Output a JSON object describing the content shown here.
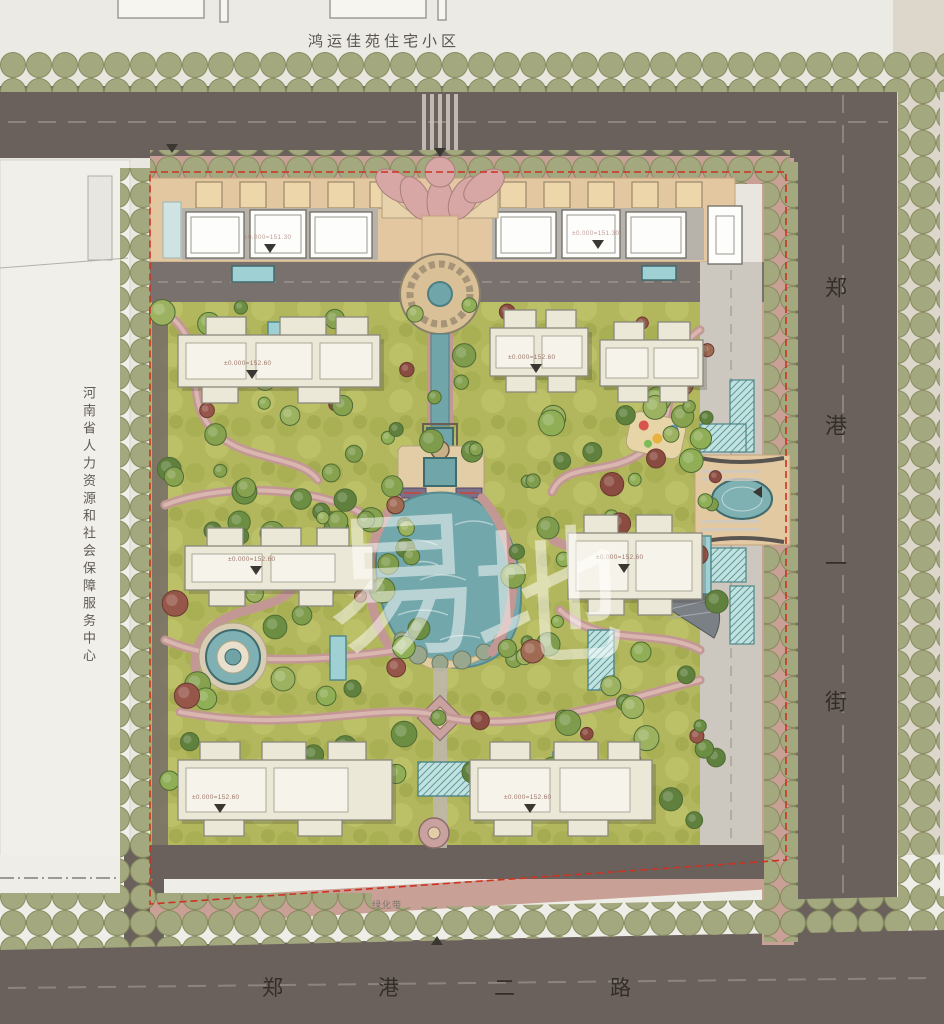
{
  "site": {
    "north_neighbor": "鸿运佳苑住宅小区",
    "west_neighbor": "河南省人力资源和社会保障服务中心",
    "east_road": "郑港一街",
    "south_road": "郑港二路",
    "green_belt": "绿化带"
  },
  "annotations": {
    "commercial_elevation": "±0.000=151.30",
    "residential_elevation": "±0.000=152.60"
  },
  "watermark": "易地",
  "colors": {
    "road": "#6a605c",
    "sidewalk": "#c9a096",
    "street_tree": "#a3a87e",
    "lawn": "#b2b75d",
    "lake": "#72a7ab",
    "building": "#ece8d7",
    "commercial": "#fdfdfb",
    "tan_band": "#e2c7a0",
    "path": "#c39793",
    "boundary": "#cc3322",
    "parcel": "#f1efea"
  }
}
